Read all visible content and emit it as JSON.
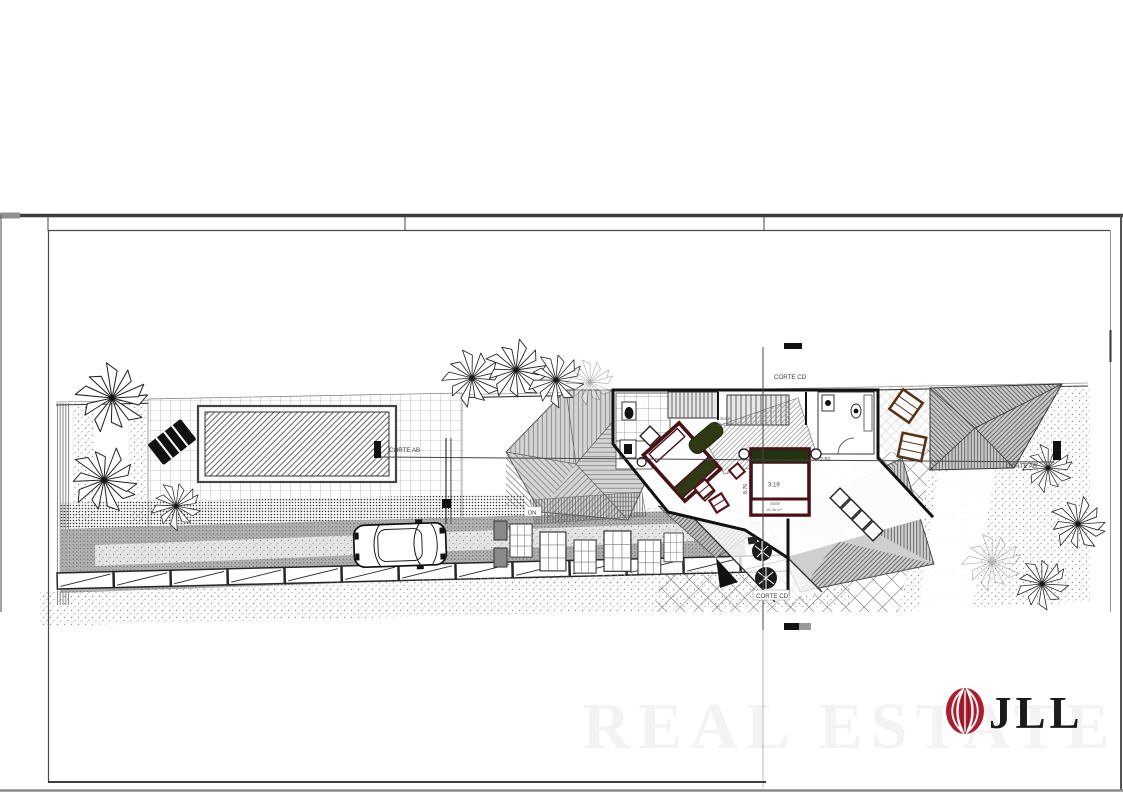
{
  "page": {
    "background": "#ffffff"
  },
  "drawing": {
    "section_labels": {
      "corte_ab_left": "CORTE AB",
      "corte_ab_right": "CORTE AB",
      "corte_cd_top": "CORTE CD",
      "corte_cd_bottom": "CORTE CD"
    },
    "annotations": {
      "stair_direction": "DN",
      "dim_bed_width": "3.19",
      "dim_room_right": "2.51",
      "dim_vertical": "8.76",
      "suite_main_name": "Suite",
      "suite_main_area": "16.41 m²",
      "suite_second_name": "Suite",
      "suite_second_area": "16.36 m²"
    },
    "colors": {
      "ink": "#1a1a1a",
      "roof_gray": "#c9c9c9",
      "furniture_maroon": "#4a1016",
      "furniture_olive": "#2f3a14",
      "wood_brown": "#5a3214"
    }
  },
  "branding": {
    "logo_text": "JLL",
    "logo_color": "#b01c2c",
    "watermark_text": "REAL ESTATE"
  }
}
